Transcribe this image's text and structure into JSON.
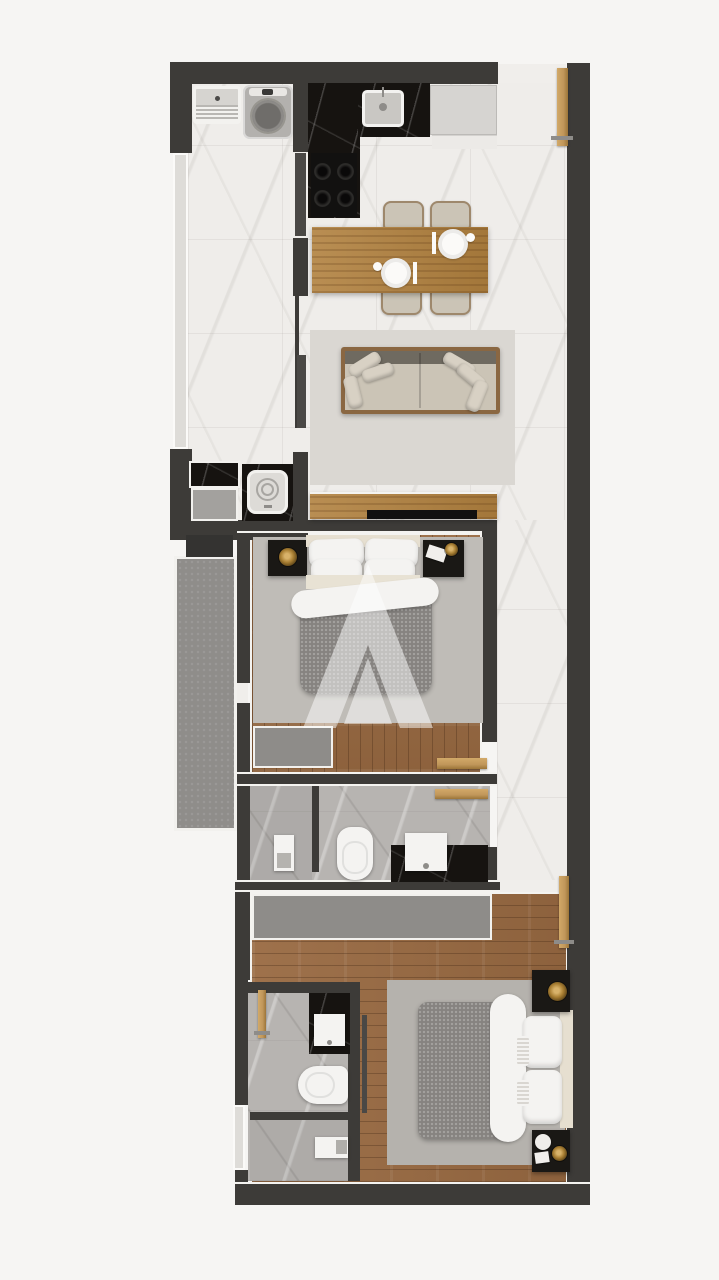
{
  "document": {
    "type": "floor-plan-rendering",
    "title": "Two-bedroom apartment floor plan, top-down 3D render",
    "watermark_letter": "A"
  },
  "palette": {
    "bg": "#f6f5f3",
    "wall": "#3d3b38",
    "marble": "#efedea",
    "grayMarble": "#b7b4b1",
    "wood": "#996a42",
    "tableWood": "#b1813f",
    "blackMarble": "#161310",
    "balcony": "#8f8d8a",
    "rug": "#dad7d2",
    "rugBed1": "#bfbcb7",
    "rugBed2": "#b5b2ad",
    "sofaBody": "#cbc4b6",
    "sofaFrame": "#8a6742",
    "pillow": "#d8d1c4",
    "duvet": "#868380",
    "white": "#f4f3f1",
    "cream": "#e6dfd0",
    "gold": "#c0965a",
    "night": "#1a1815",
    "appliance": "#b3b1ae",
    "windowStrip": "#dedcd8",
    "threshold": "#f0eeeb",
    "tv": "#111010",
    "acUnit": "#343331",
    "doorDark": "#4a4845",
    "wardrobe": "#8e8c89"
  },
  "rooms": {
    "kitchen": {
      "label": "Kitchen",
      "furniture": [
        "L-shaped black marble counter",
        "sink",
        "cooktop with 4 burners",
        "refrigerator"
      ]
    },
    "dining": {
      "label": "Dining area",
      "furniture": [
        "wooden table",
        "4 upholstered chairs",
        "2 place settings"
      ]
    },
    "living": {
      "label": "Living area",
      "furniture": [
        "sofa with cushions",
        "area rug",
        "wooden TV console",
        "TV"
      ]
    },
    "laundry": {
      "label": "Laundry nook",
      "furniture": [
        "laundry tub",
        "washing machine"
      ]
    },
    "utility": {
      "label": "Utility closet",
      "furniture": [
        "black marble counter",
        "top-loading appliance"
      ]
    },
    "balcony": {
      "label": "Balcony",
      "furniture": [
        "AC unit"
      ]
    },
    "bedroom1": {
      "label": "Bedroom 1",
      "furniture": [
        "double bed",
        "2 nightstands",
        "wardrobe",
        "rug"
      ]
    },
    "bathroom1": {
      "label": "Bathroom",
      "furniture": [
        "toilet",
        "black marble vanity with sink",
        "shower partition"
      ]
    },
    "hallway": {
      "label": "Hallway"
    },
    "bedroom2": {
      "label": "Bedroom 2",
      "furniture": [
        "double bed",
        "2 nightstands",
        "long wardrobe",
        "rug"
      ]
    },
    "bathroom2": {
      "label": "En-suite bathroom",
      "furniture": [
        "toilet",
        "black marble vanity with sink",
        "shower with drain"
      ]
    },
    "entry": {
      "label": "Entry",
      "furniture": [
        "wooden entry door"
      ]
    }
  }
}
